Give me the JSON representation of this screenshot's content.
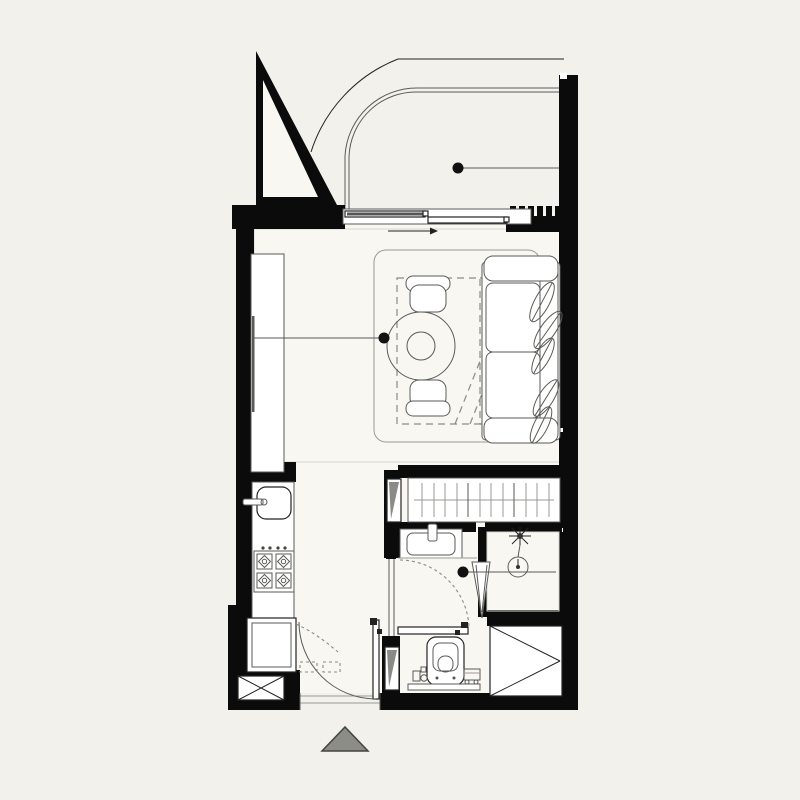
{
  "canvas": {
    "width": 800,
    "height": 800
  },
  "colors": {
    "background": "#f3f1ec",
    "interior_floor": "#f8f7f2",
    "wall": "#0b0b0b",
    "line_strong": "#232323",
    "line_medium": "#5a5a57",
    "line_light": "#9a9a95",
    "dashed": "#8a8a86",
    "marker": "#111111",
    "entrance_arrow_fill": "#8d8d88",
    "entrance_arrow_stroke": "#44443f"
  },
  "drawing": {
    "kind": "studio-apartment-floor-plan",
    "text_labels": [],
    "annotation_markers": [
      {
        "name": "balcony-marker",
        "leader": "to-right-wall"
      },
      {
        "name": "living-room-marker",
        "leader": "to-left-cabinet"
      },
      {
        "name": "bathroom-marker",
        "leader": "to-right-wall"
      }
    ]
  },
  "legend": {
    "fixtures": [
      {
        "icon": "privacy-screen-triangle-icon",
        "area": "balcony",
        "count": 1
      },
      {
        "icon": "balcony-railing-icon",
        "area": "balcony",
        "count": 1
      },
      {
        "icon": "sliding-door-icon",
        "area": "balcony-edge",
        "count": 1,
        "panels": 2
      },
      {
        "icon": "vent-grille-icon",
        "area": "balcony-edge",
        "teeth": 7
      },
      {
        "icon": "wardrobe-cabinet-icon",
        "area": "living-room",
        "count": 1
      },
      {
        "icon": "rug-icon",
        "area": "living-room",
        "count": 1
      },
      {
        "icon": "round-dining-table-icon",
        "area": "living-room",
        "count": 1
      },
      {
        "icon": "dining-chair-icon",
        "area": "living-room",
        "count": 2
      },
      {
        "icon": "fold-out-bed-dashed-icon",
        "area": "living-room",
        "count": 1
      },
      {
        "icon": "sofa-icon",
        "area": "living-room",
        "count": 1,
        "leaf_cushions": 5
      },
      {
        "icon": "kitchen-sink-icon",
        "area": "kitchen",
        "count": 1
      },
      {
        "icon": "cooktop-icon",
        "area": "kitchen",
        "burners": 4,
        "knobs": 4
      },
      {
        "icon": "washing-machine-icon",
        "area": "kitchen",
        "count": 1
      },
      {
        "icon": "shaft-x-icon",
        "area": "kitchen",
        "count": 1
      },
      {
        "icon": "entry-door-swing-icon",
        "area": "entry",
        "count": 1
      },
      {
        "icon": "shoe-mat-dashed-icon",
        "area": "entry",
        "count": 2
      },
      {
        "icon": "closet-rail-icon",
        "area": "closet",
        "hangers": 12
      },
      {
        "icon": "pocket-door-icon",
        "area": "hallway",
        "count": 2
      },
      {
        "icon": "washbasin-icon",
        "area": "bathroom",
        "count": 1
      },
      {
        "icon": "bathroom-door-swing-icon",
        "area": "bathroom",
        "count": 1
      },
      {
        "icon": "shower-head-icon",
        "area": "bathroom",
        "count": 1
      },
      {
        "icon": "floor-drain-icon",
        "area": "bathroom",
        "count": 1
      },
      {
        "icon": "shower-panel-icon",
        "area": "bathroom",
        "count": 1
      },
      {
        "icon": "toilet-icon",
        "area": "bathroom",
        "count": 1
      },
      {
        "icon": "air-shaft-triangle-icon",
        "area": "bathroom",
        "count": 1
      },
      {
        "icon": "entrance-direction-triangle-icon",
        "area": "exterior",
        "count": 1
      }
    ]
  }
}
